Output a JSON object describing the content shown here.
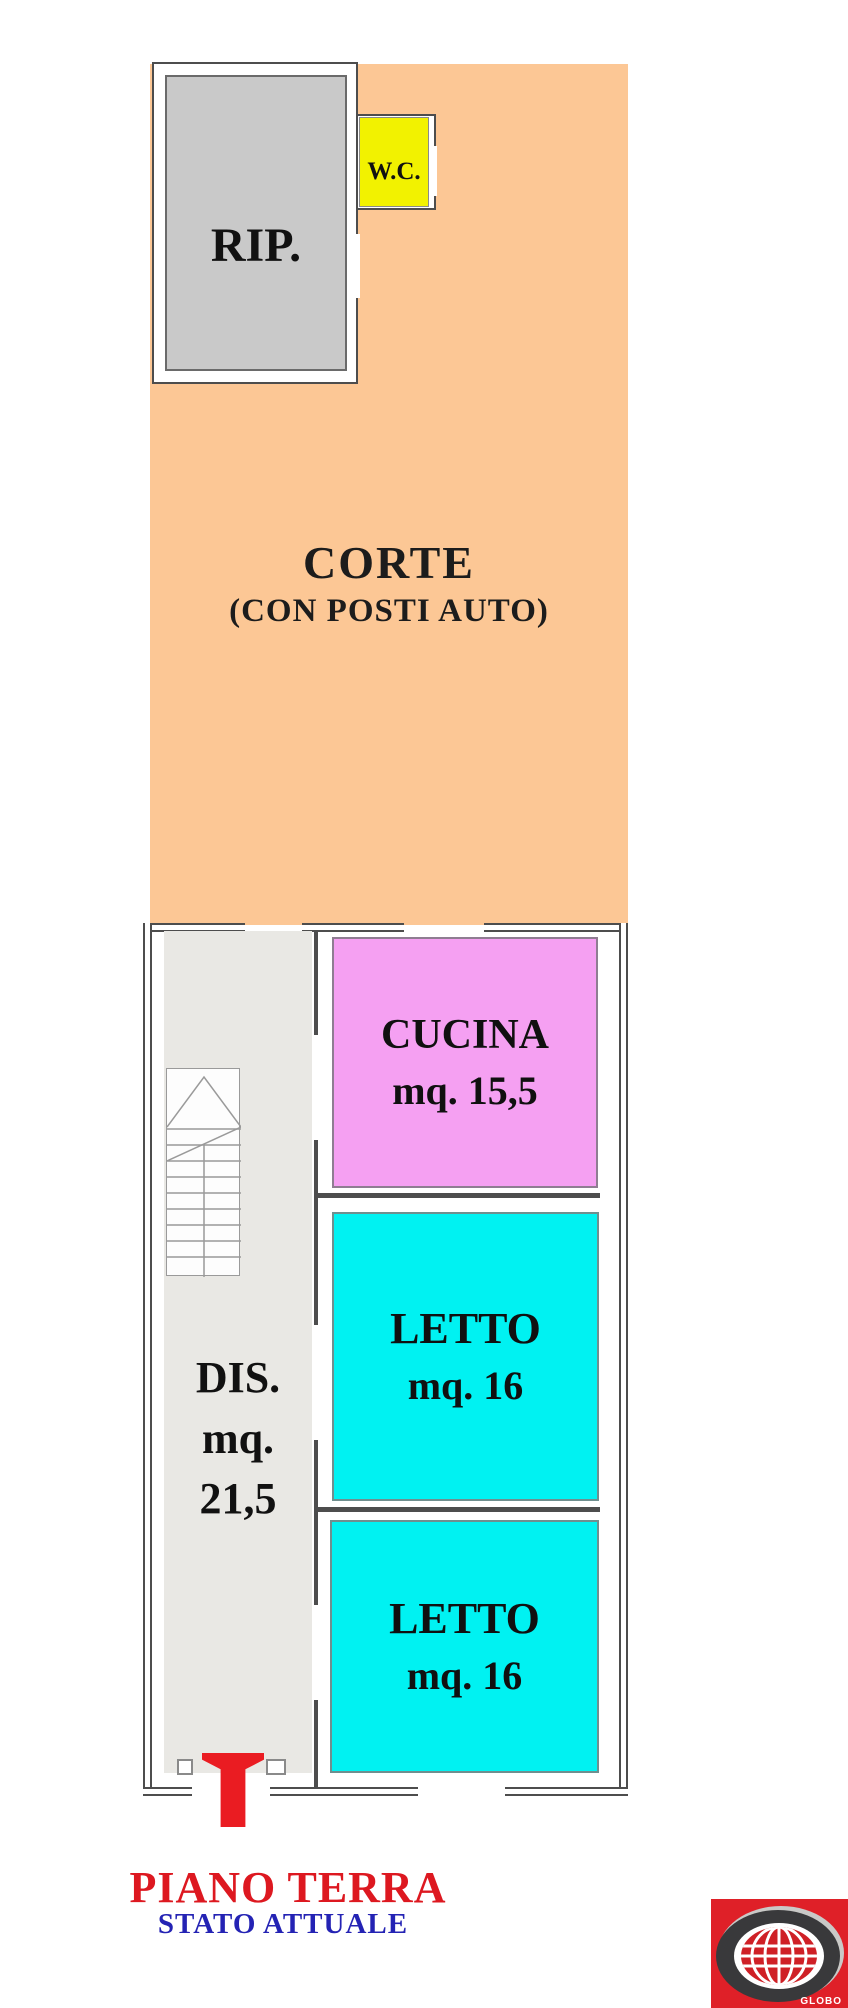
{
  "colors": {
    "corte": "#FCC795",
    "wc_yellow": "#F2F200",
    "rip_gray": "#C9C9C9",
    "dis_gray": "#E9E8E4",
    "cucina_pink": "#F5A0F2",
    "letto_cyan": "#00F2F2",
    "wall": "#4D4D4D",
    "title_red": "#DD1820",
    "subtitle_blue": "#2423B4",
    "marker_red": "#EA1C22",
    "logo_red": "#DF2028"
  },
  "rooms": {
    "corte": {
      "label": "CORTE",
      "note": "(CON POSTI AUTO)"
    },
    "rip": {
      "label": "RIP."
    },
    "wc": {
      "label": "W.C."
    },
    "cucina": {
      "label": "CUCINA",
      "area": "mq. 15,5"
    },
    "letto1": {
      "label": "LETTO",
      "area": "mq. 16"
    },
    "letto2": {
      "label": "LETTO",
      "area": "mq. 16"
    },
    "dis": {
      "label": "DIS.",
      "area_unit": "mq.",
      "area_value": "21,5"
    }
  },
  "footer": {
    "title": "PIANO TERRA",
    "subtitle": "STATO ATTUALE"
  },
  "logo": {
    "text": "GLOBO"
  }
}
